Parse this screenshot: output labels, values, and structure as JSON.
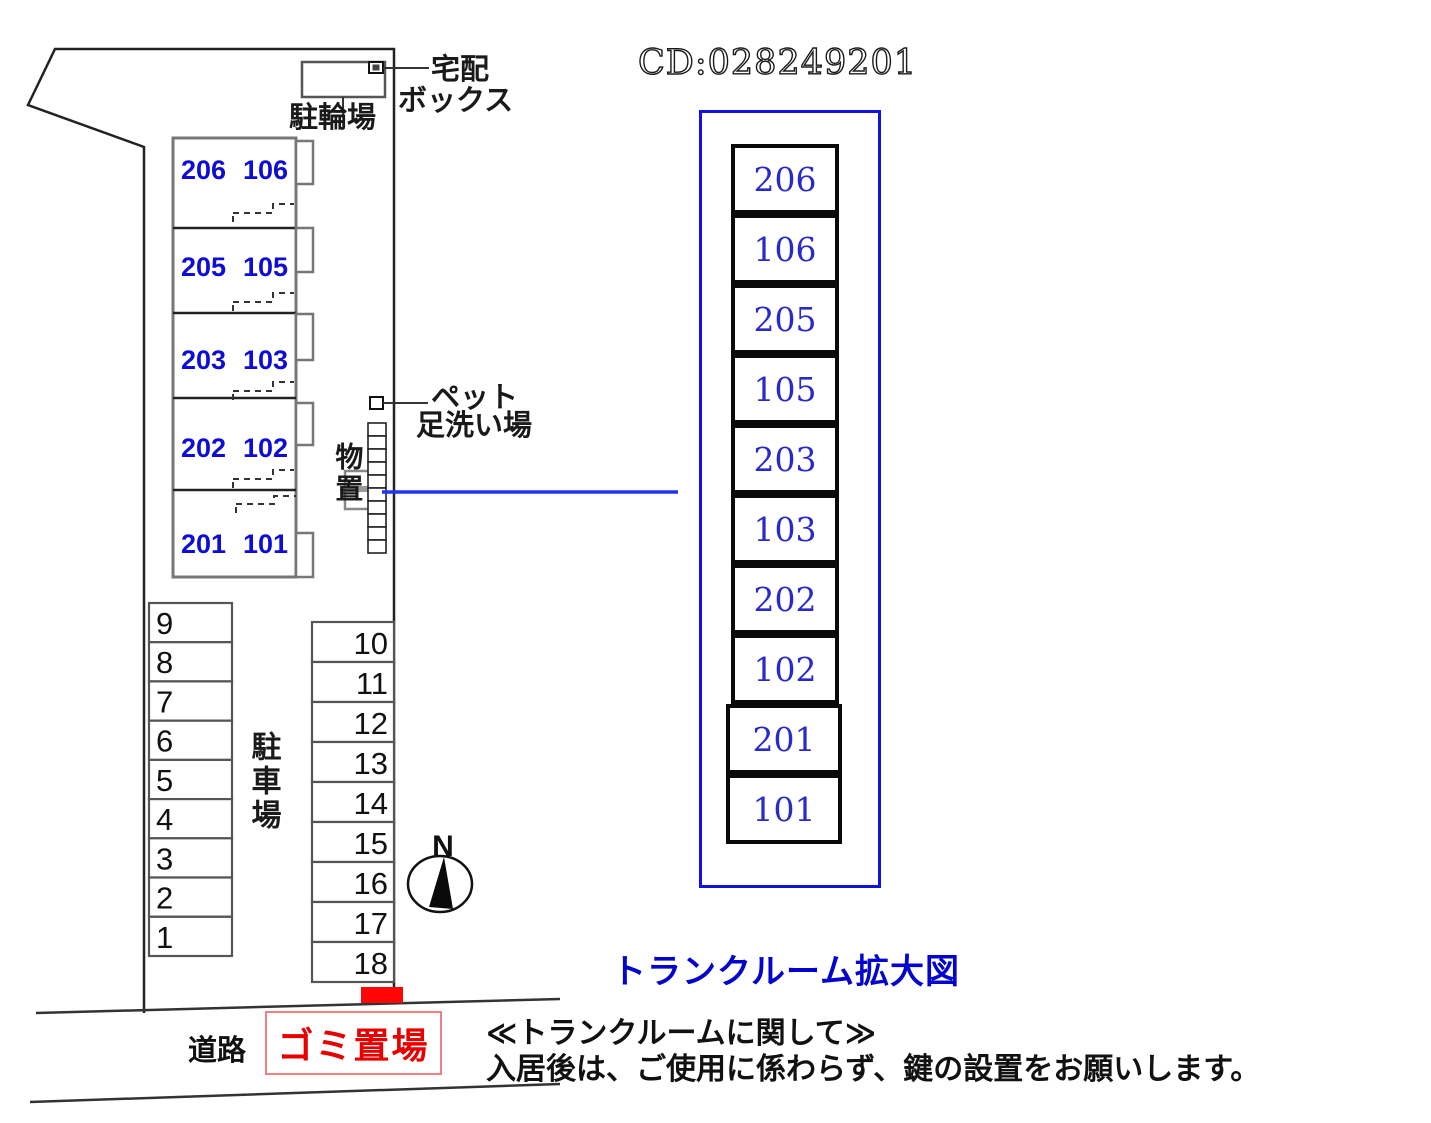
{
  "code_label": "CD:028249201",
  "site": {
    "bicycle_parking_label": "駐輪場",
    "delivery_box_label_1": "宅配",
    "delivery_box_label_2": "ボックス",
    "pet_wash_label_1": "ペット",
    "pet_wash_label_2": "足洗い場",
    "storage_label": "物置",
    "parking_lot_label": "駐車場",
    "road_label": "道路",
    "garbage_area_label": "ゴミ置場",
    "compass_label": "N",
    "units": [
      {
        "left": "206",
        "right": "106"
      },
      {
        "left": "205",
        "right": "105"
      },
      {
        "left": "203",
        "right": "103"
      },
      {
        "left": "202",
        "right": "102"
      },
      {
        "left": "201",
        "right": "101"
      }
    ],
    "parking_left": [
      "9",
      "8",
      "7",
      "6",
      "5",
      "4",
      "3",
      "2",
      "1"
    ],
    "parking_right": [
      "10",
      "11",
      "12",
      "13",
      "14",
      "15",
      "16",
      "17",
      "18"
    ]
  },
  "trunk_view": {
    "title": "トランクルーム拡大図",
    "cells": [
      "206",
      "106",
      "205",
      "105",
      "203",
      "103",
      "202",
      "102",
      "201",
      "101"
    ]
  },
  "note": {
    "line1": "≪トランクルームに関して≫",
    "line2": "入居後は、ご使用に係わらず、鍵の設置をお願いします。"
  },
  "colors": {
    "unit_number_blue": "#0d0dd5",
    "trunk_number_blue": "#2a2ac8",
    "trunk_border_blue": "#1212dd",
    "connector_blue": "#2233ee",
    "title_blue": "#0404cc",
    "marker_red": "#ff0505",
    "garbage_border_red": "#f08080",
    "garbage_text_red": "#e80000"
  }
}
